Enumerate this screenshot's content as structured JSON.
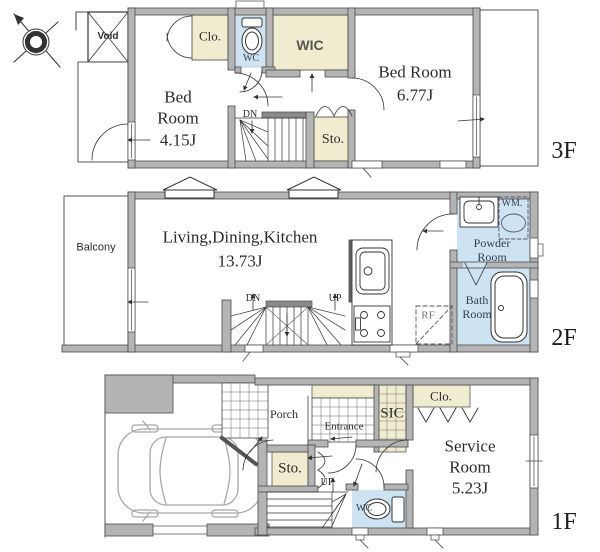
{
  "title": "3-story house floor plan",
  "colors": {
    "wall": "#b4b4b4",
    "closet_beige": "#f0ecd0",
    "wet_blue": "#cde3f2",
    "line": "#3c3c3c"
  },
  "f3": {
    "tag": "3F",
    "void": "Void",
    "clo": "Clo.",
    "wc": "WC",
    "wic": "WIC",
    "dn": "DN",
    "sto": "Sto.",
    "bed_small": [
      "Bed",
      "Room",
      "4.15J"
    ],
    "bed_large": [
      "Bed Room",
      "6.77J"
    ]
  },
  "f2": {
    "tag": "2F",
    "balcony": "Balcony",
    "ldk": [
      "Living,Dining,Kitchen",
      "13.73J"
    ],
    "dn": "DN",
    "up": "UP",
    "rf": "RF",
    "wm": "WM.",
    "powder": [
      "Powder",
      "Room"
    ],
    "bath": [
      "Bath",
      "Room"
    ]
  },
  "f1": {
    "tag": "1F",
    "porch": "Porch",
    "entrance": "Entrance",
    "sic": "SIC",
    "clo": "Clo.",
    "service": [
      "Service",
      "Room",
      "5.23J"
    ],
    "wc": "WC",
    "sto": "Sto.",
    "up": "UP"
  }
}
